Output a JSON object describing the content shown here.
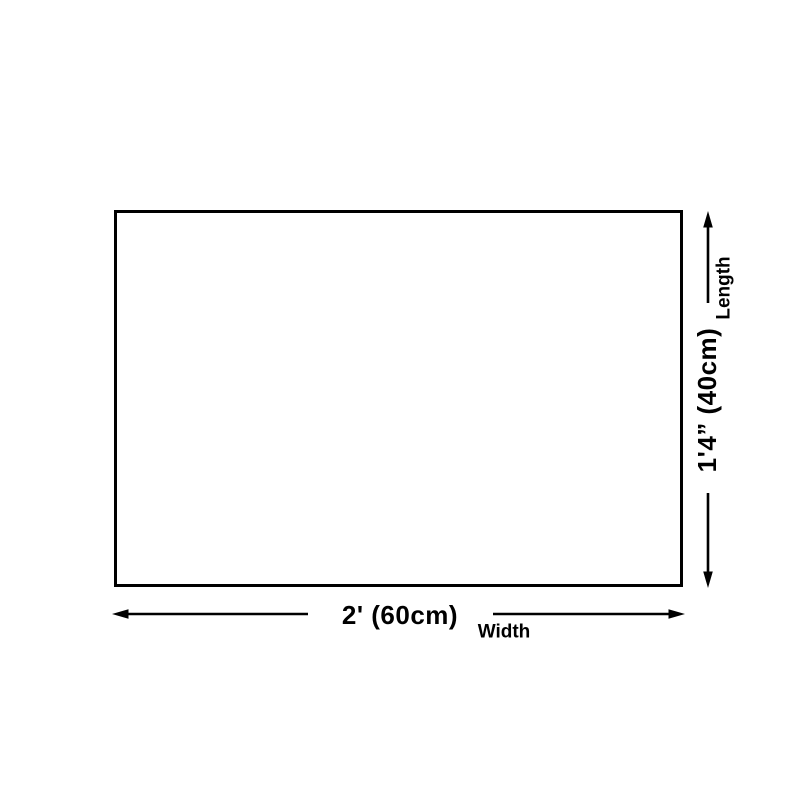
{
  "diagram": {
    "width_dimension": {
      "value": "2' (60cm)",
      "label": "Width"
    },
    "length_dimension": {
      "value": "1'4” (40cm)",
      "label": "Length"
    },
    "icons": [
      "width-arrow-left-icon",
      "width-arrow-right-icon",
      "length-arrow-up-icon",
      "length-arrow-down-icon"
    ],
    "colors": {
      "line": "#000000",
      "text": "#000000",
      "background": "#ffffff",
      "product_fill": "#ffffff",
      "product_border": "#000000"
    }
  }
}
